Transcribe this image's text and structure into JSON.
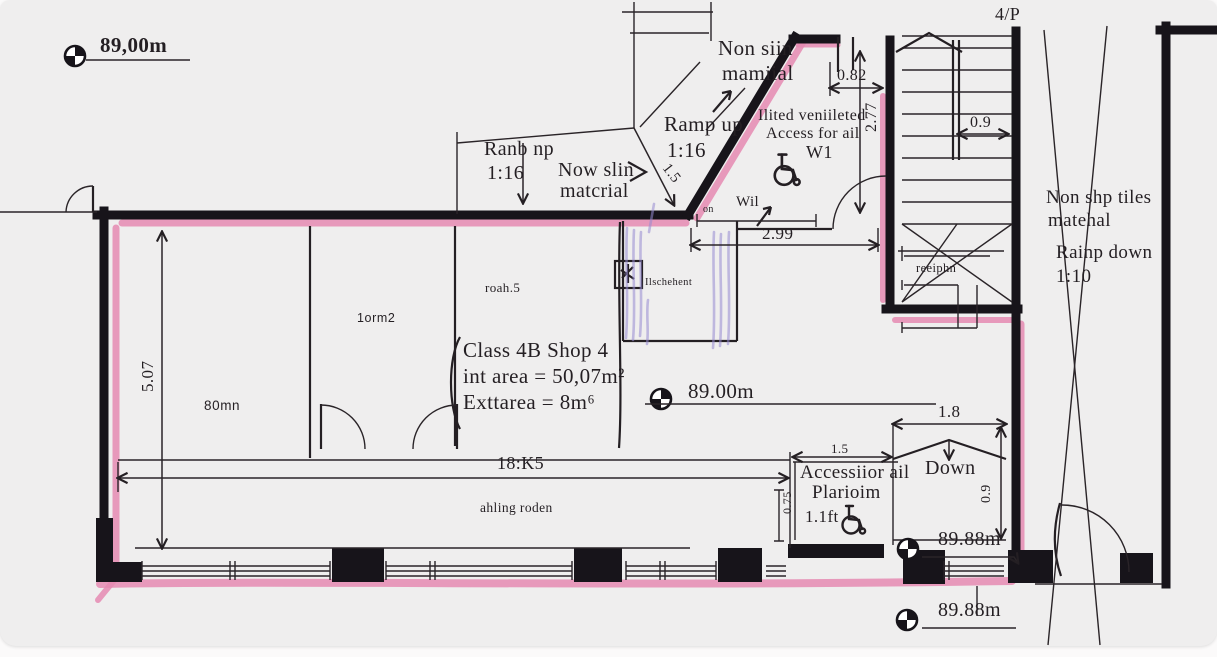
{
  "colors": {
    "wall": "#17141a",
    "route_highlight": "#e58ab1",
    "hatch_highlight": "#958bd1",
    "ink": "#241f23",
    "paper": "#efeeee"
  },
  "icons": {
    "level_marker": "benchmark-icon",
    "wheelchair": "wheelchair-icon"
  },
  "levels": {
    "top_left": "89,00m",
    "center": "89.00m",
    "platform": "89.88m",
    "entry": "89.88m"
  },
  "labels": {
    "sheet_ref": "4/P",
    "non_slip_top_1": "Non siin",
    "non_slip_top_2": "mamiial",
    "ramp_up_1": "Ramp up",
    "ramp_up_2": "1:16",
    "ramp_left_1": "Ranb np",
    "ramp_left_2": "1:16",
    "non_slip_mid_1": "Now slin",
    "non_slip_mid_2": "matcrial",
    "wc_1": "Ilited veniileted",
    "wc_2": "Access for ail",
    "wc_3": "W1",
    "wil": "Wil",
    "on": "on",
    "tiles_1": "Non shp tiles",
    "tiles_2": "matehal",
    "ramp_down_1": "Rainp down",
    "ramp_down_2": "1:10",
    "reception": "reeiphn",
    "fixture": "Ilschehent",
    "room_small_1": "roah.5",
    "room_small_2": "1orm2",
    "room_small_3": "80mn",
    "shop_1": "Class 4B Shop 4",
    "shop_2": "int area = 50,07m²",
    "shop_3": "Exttarea = 8m⁶",
    "awning": "ahling roden",
    "platform_1": "Accessiior ail",
    "platform_2": "Plarioim",
    "platform_3": "1.1ft",
    "down": "Down"
  },
  "dims": {
    "w082": "0.82",
    "w09top": "0.9",
    "h277": "2.77",
    "ramp15": "1.5",
    "w299": "2.99",
    "h507": "5.07",
    "w18k5": "18:K5",
    "w18": "1.8",
    "w15": "1.5",
    "h075": "0.75",
    "h09": "0.9"
  }
}
